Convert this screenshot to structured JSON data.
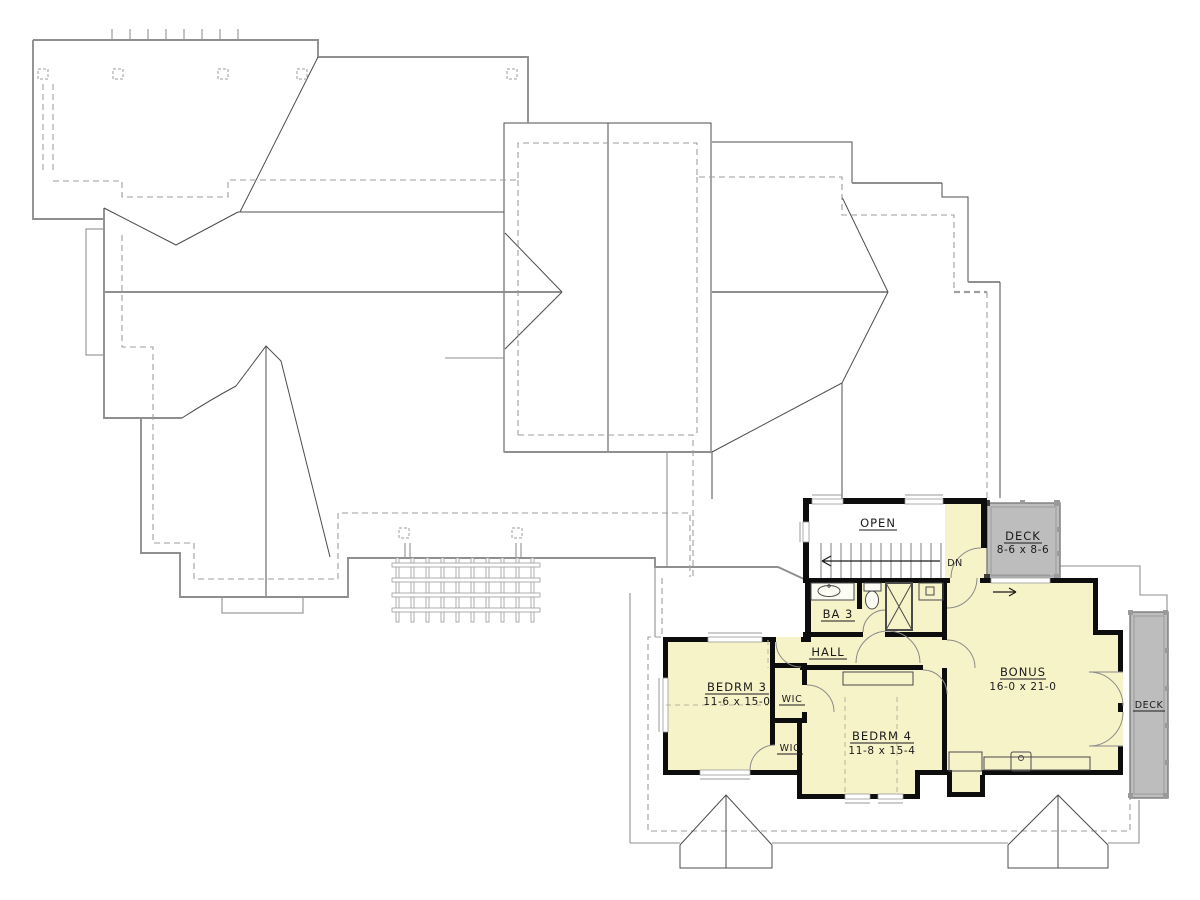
{
  "drawing": {
    "type": "upper floor plan with roof plan"
  },
  "rooms": {
    "open": {
      "label": "OPEN"
    },
    "stairs": {
      "direction": "DN"
    },
    "deck_upper": {
      "label": "DECK",
      "size": "8-6 x 8-6"
    },
    "bath3": {
      "label": "BA 3"
    },
    "hall": {
      "label": "HALL"
    },
    "bedroom3": {
      "label": "BEDRM 3",
      "size": "11-6 x 15-0"
    },
    "wic_upper": {
      "label": "WIC"
    },
    "wic_lower": {
      "label": "WIC"
    },
    "bedroom4": {
      "label": "BEDRM 4",
      "size": "11-8 x 15-4"
    },
    "bonus": {
      "label": "BONUS",
      "size": "16-0 x 21-0"
    },
    "deck_right": {
      "label": "DECK"
    }
  },
  "colors": {
    "room_fill": "#F7F3C9",
    "deck_fill": "#BDBDBD",
    "wall": "#0D0D0D",
    "roof_line": "#8F8F8F",
    "dark_line": "#4D4D4D",
    "dashed_line": "#9E9E9E",
    "text": "#1A1A1A",
    "background": "#FFFFFF"
  }
}
